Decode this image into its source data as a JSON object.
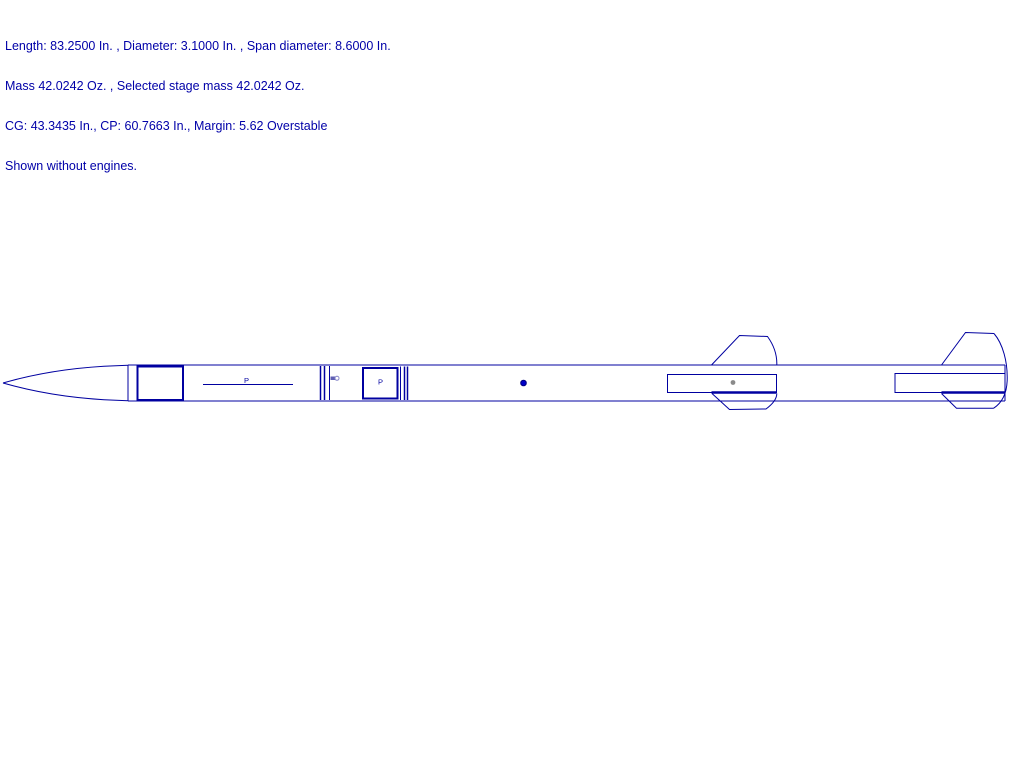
{
  "header": {
    "line1": "Length: 83.2500 In. , Diameter: 3.1000 In. , Span diameter: 8.6000 In.",
    "line2": "Mass 42.0242 Oz. , Selected stage mass 42.0242 Oz.",
    "line3": "CG: 43.3435 In., CP: 60.7663 In., Margin: 5.62 Overstable",
    "line4": "Shown without engines."
  },
  "diagram": {
    "labels": {
      "p1": "P",
      "p2": "P"
    }
  },
  "colors": {
    "text-color": "#0000A8",
    "line-color": "#0000A0",
    "cg-dot-color": "#0000C8",
    "marker-gray": "#8a8a8a"
  }
}
